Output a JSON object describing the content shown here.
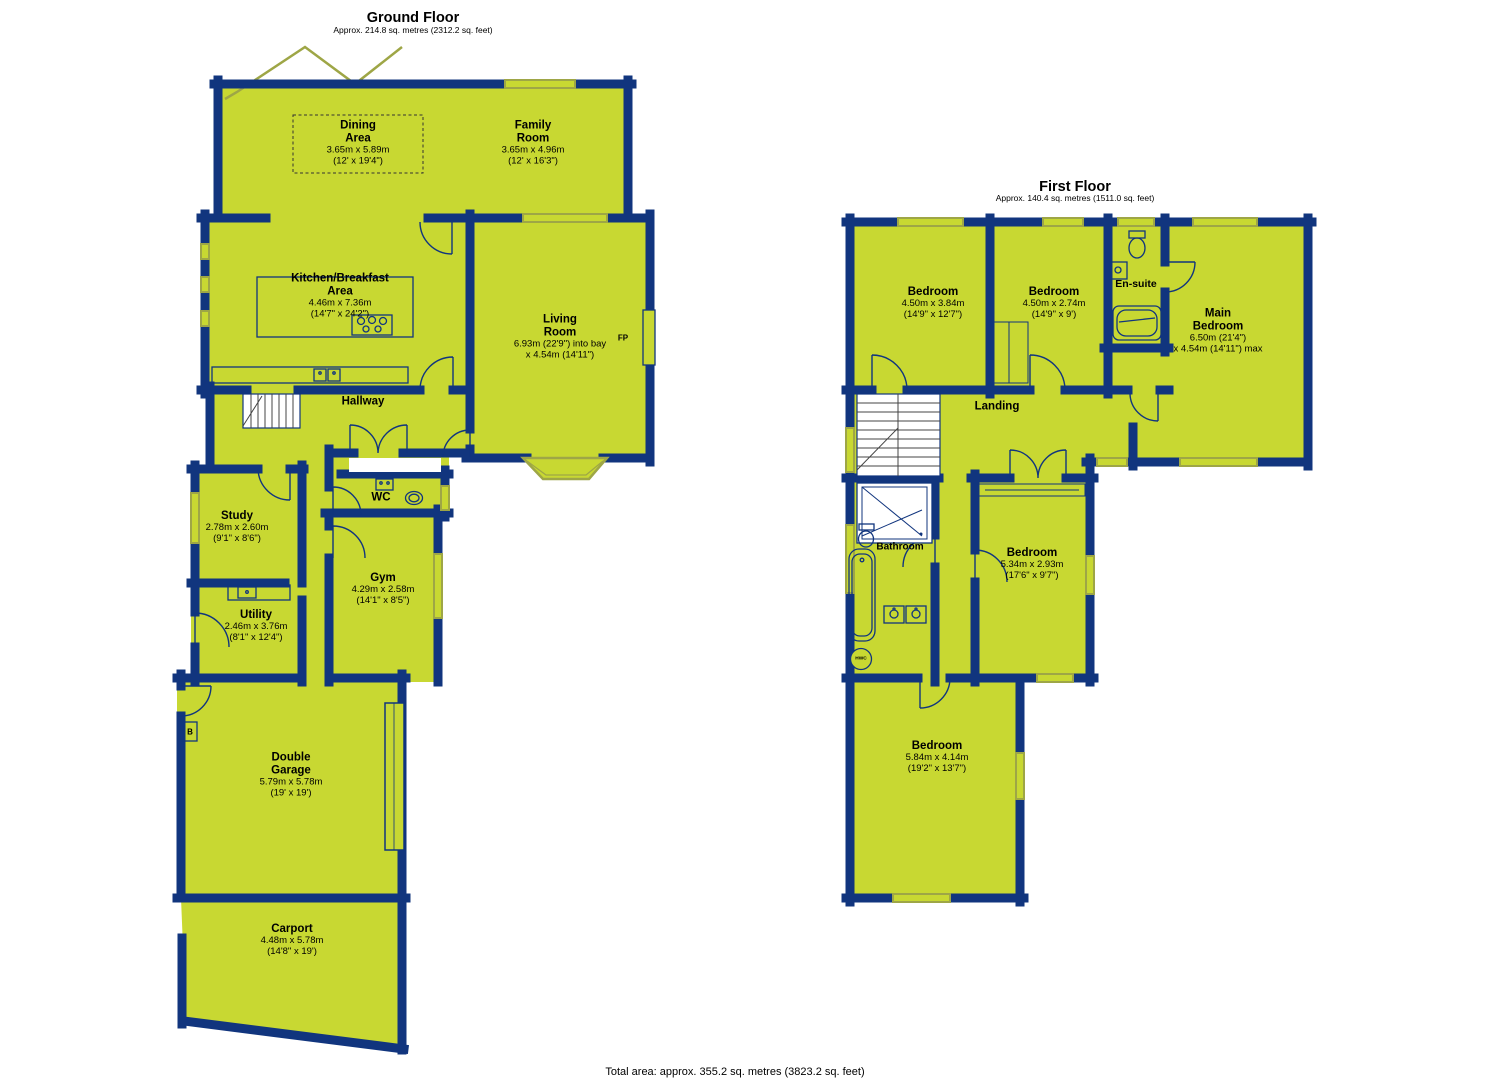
{
  "colors": {
    "room_fill": "#c8d832",
    "wall": "#11357e",
    "window_line": "#9ea646",
    "text": "#000000",
    "background": "#ffffff"
  },
  "ground_floor": {
    "title": "Ground Floor",
    "subtitle": "Approx. 214.8 sq. metres (2312.2 sq. feet)",
    "rooms": {
      "dining": {
        "name": "Dining\nArea",
        "metric": "3.65m x 5.89m",
        "imperial": "(12' x 19'4\")"
      },
      "family": {
        "name": "Family\nRoom",
        "metric": "3.65m x 4.96m",
        "imperial": "(12' x 16'3\")"
      },
      "kitchen": {
        "name": "Kitchen/Breakfast\nArea",
        "metric": "4.46m x 7.36m",
        "imperial": "(14'7\" x 24'2\")"
      },
      "living": {
        "name": "Living\nRoom",
        "metric": "6.93m (22'9\") into bay",
        "imperial": "x 4.54m (14'11\")"
      },
      "hallway": {
        "name": "Hallway"
      },
      "wc": {
        "name": "WC"
      },
      "study": {
        "name": "Study",
        "metric": "2.78m x 2.60m",
        "imperial": "(9'1\" x 8'6\")"
      },
      "gym": {
        "name": "Gym",
        "metric": "4.29m x 2.58m",
        "imperial": "(14'1\" x 8'5\")"
      },
      "utility": {
        "name": "Utility",
        "metric": "2.46m x 3.76m",
        "imperial": "(8'1\" x 12'4\")"
      },
      "garage": {
        "name": "Double\nGarage",
        "metric": "5.79m x 5.78m",
        "imperial": "(19' x 19')"
      },
      "carport": {
        "name": "Carport",
        "metric": "4.48m x 5.78m",
        "imperial": "(14'8\" x 19')"
      }
    },
    "annotations": {
      "fireplace": "FP",
      "boiler": "B"
    }
  },
  "first_floor": {
    "title": "First Floor",
    "subtitle": "Approx. 140.4 sq. metres (1511.0 sq. feet)",
    "rooms": {
      "bedroom1": {
        "name": "Bedroom",
        "metric": "4.50m x 3.84m",
        "imperial": "(14'9\" x 12'7\")"
      },
      "bedroom2": {
        "name": "Bedroom",
        "metric": "4.50m x 2.74m",
        "imperial": "(14'9\" x 9')"
      },
      "ensuite": {
        "name": "En-suite"
      },
      "main_bedroom": {
        "name": "Main\nBedroom",
        "metric": "6.50m (21'4\")",
        "imperial": "x 4.54m (14'11\") max"
      },
      "landing": {
        "name": "Landing"
      },
      "bathroom": {
        "name": "Bathroom"
      },
      "bedroom3": {
        "name": "Bedroom",
        "metric": "5.34m x 2.93m",
        "imperial": "(17'6\" x 9'7\")"
      },
      "bedroom4": {
        "name": "Bedroom",
        "metric": "5.84m x 4.14m",
        "imperial": "(19'2\" x 13'7\")"
      }
    },
    "annotations": {
      "hot_water_cylinder": "HWC"
    }
  },
  "footer": {
    "total_area": "Total area: approx. 355.2 sq. metres (3823.2 sq. feet)"
  }
}
